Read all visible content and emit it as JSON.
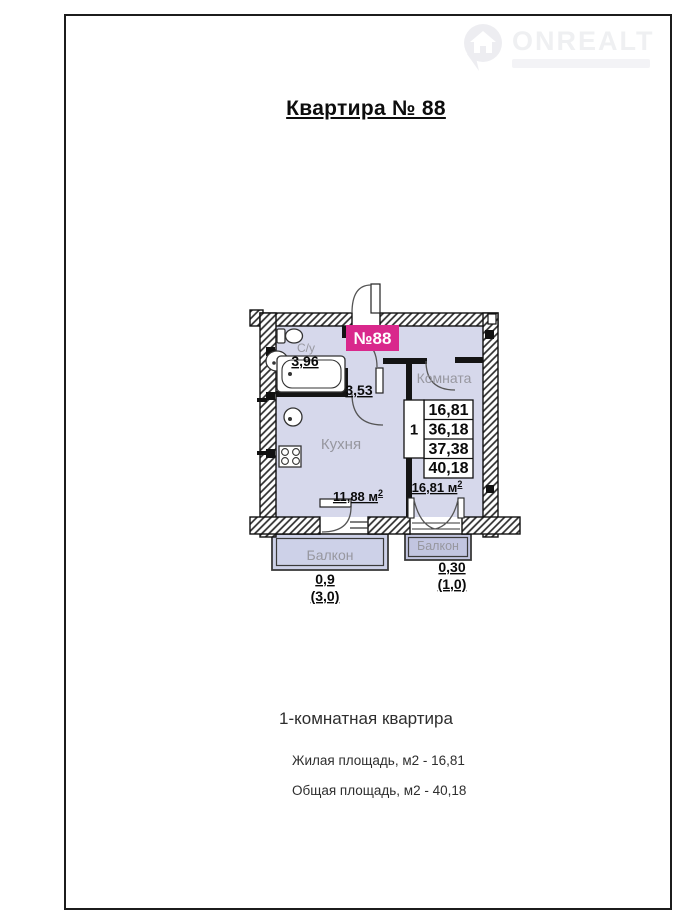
{
  "page": {
    "title": "Квартира № 88",
    "watermark": {
      "brand": "ONREALT"
    },
    "footer": {
      "heading": "1-комнатная квартира",
      "living_area": "Жилая площадь, м2 - 16,81",
      "total_area": "Общая площадь, м2 - 40,18"
    }
  },
  "plan": {
    "apartment_badge": "№88",
    "rooms": {
      "bathroom": {
        "label": "С/у",
        "area": "3,96"
      },
      "hall": {
        "area": "3,53"
      },
      "room": {
        "label": "Комната",
        "area_label": "16,81 м",
        "area_sup": "2"
      },
      "kitchen": {
        "label": "Кухня",
        "area_label": "11,88 м",
        "area_sup": "2"
      },
      "balcony_left": {
        "label": "Балкон",
        "value": "0,9",
        "coef_value": "(3,0)"
      },
      "balcony_right": {
        "label": "Балкон",
        "value": "0,30",
        "coef_value": "(1,0)"
      }
    },
    "area_table": {
      "rooms_count": "1",
      "rows": [
        "16,81",
        "36,18",
        "37,38",
        "40,18"
      ]
    },
    "colors": {
      "interior": "#d6d8eb",
      "badge": "#d9288c"
    }
  }
}
